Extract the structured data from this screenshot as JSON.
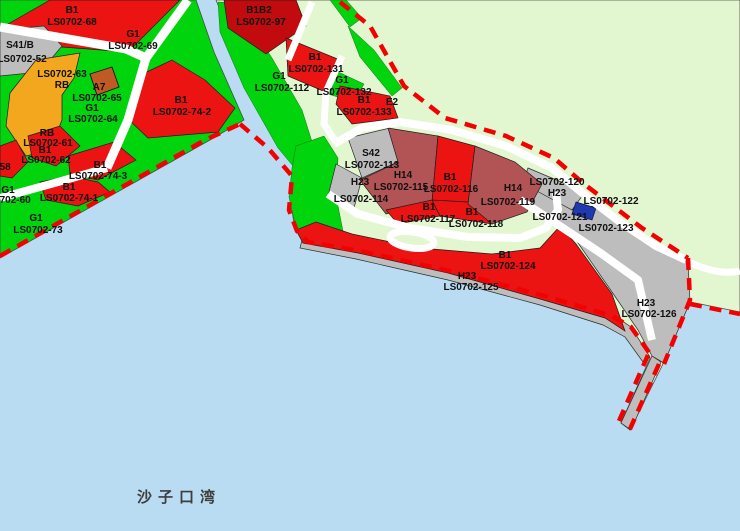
{
  "map_title": "Shazikou Bay zoning map",
  "bay": {
    "label": "沙子口湾"
  },
  "colors": {
    "water": "#b9dcf3",
    "vegetation_green": "#00d40c",
    "pale_land": "#e2f6cf",
    "commercial_red": "#ec1313",
    "mixed_commercial_dark_red": "#c20b0e",
    "port_maroon": "#b25355",
    "residential_orange": "#f2a71e",
    "civic_brown": "#bf5a25",
    "utility_blue": "#2038b0",
    "transport_gray": "#bdbdbd",
    "boundary_red": "#f30000",
    "road_white": "#ffffff"
  },
  "parcels": [
    {
      "zone": "B1",
      "code": "LS0702-68"
    },
    {
      "zone": "G1",
      "code": "LS0702-69"
    },
    {
      "zone": "S41/B",
      "code": "LS0702-52"
    },
    {
      "zone": "LS0702-63",
      "code": "RB"
    },
    {
      "zone": "A7",
      "code": "LS0702-65"
    },
    {
      "zone": "G1",
      "code": "LS0702-64"
    },
    {
      "zone": "RB",
      "code": "LS0702-61"
    },
    {
      "zone": "B1",
      "code": "LS0702-62"
    },
    {
      "zone": "",
      "code": "LS0702-58"
    },
    {
      "zone": "G1",
      "code": "LS0702-60"
    },
    {
      "zone": "B1",
      "code": "LS0702-74-1"
    },
    {
      "zone": "B1",
      "code": "LS0702-74-3"
    },
    {
      "zone": "G1",
      "code": "LS0702-73"
    },
    {
      "zone": "B1",
      "code": "LS0702-74-2"
    },
    {
      "zone": "B1B2",
      "code": "LS0702-97"
    },
    {
      "zone": "B1",
      "code": "LS0702-131"
    },
    {
      "zone": "G1",
      "code": "LS0702-132"
    },
    {
      "zone": "B1",
      "code": "LS0702-133"
    },
    {
      "zone": "E2",
      "code": ""
    },
    {
      "zone": "G1",
      "code": "LS0702-112"
    },
    {
      "zone": "S42",
      "code": "LS0702-113"
    },
    {
      "zone": "H23",
      "code": "LS0702-114"
    },
    {
      "zone": "H14",
      "code": "LS0702-115"
    },
    {
      "zone": "B1",
      "code": "LS0702-116"
    },
    {
      "zone": "B1",
      "code": "LS0702-117"
    },
    {
      "zone": "B1",
      "code": "LS0702-118"
    },
    {
      "zone": "H14",
      "code": "LS0702-119"
    },
    {
      "zone": "LS0702-120",
      "code": "H23"
    },
    {
      "zone": "",
      "code": "LS0702-122"
    },
    {
      "zone": "",
      "code": "LS0702-121"
    },
    {
      "zone": "",
      "code": "LS0702-123"
    },
    {
      "zone": "B1",
      "code": "LS0702-124"
    },
    {
      "zone": "H23",
      "code": "LS0702-125"
    },
    {
      "zone": "H23",
      "code": "LS0702-126"
    }
  ]
}
